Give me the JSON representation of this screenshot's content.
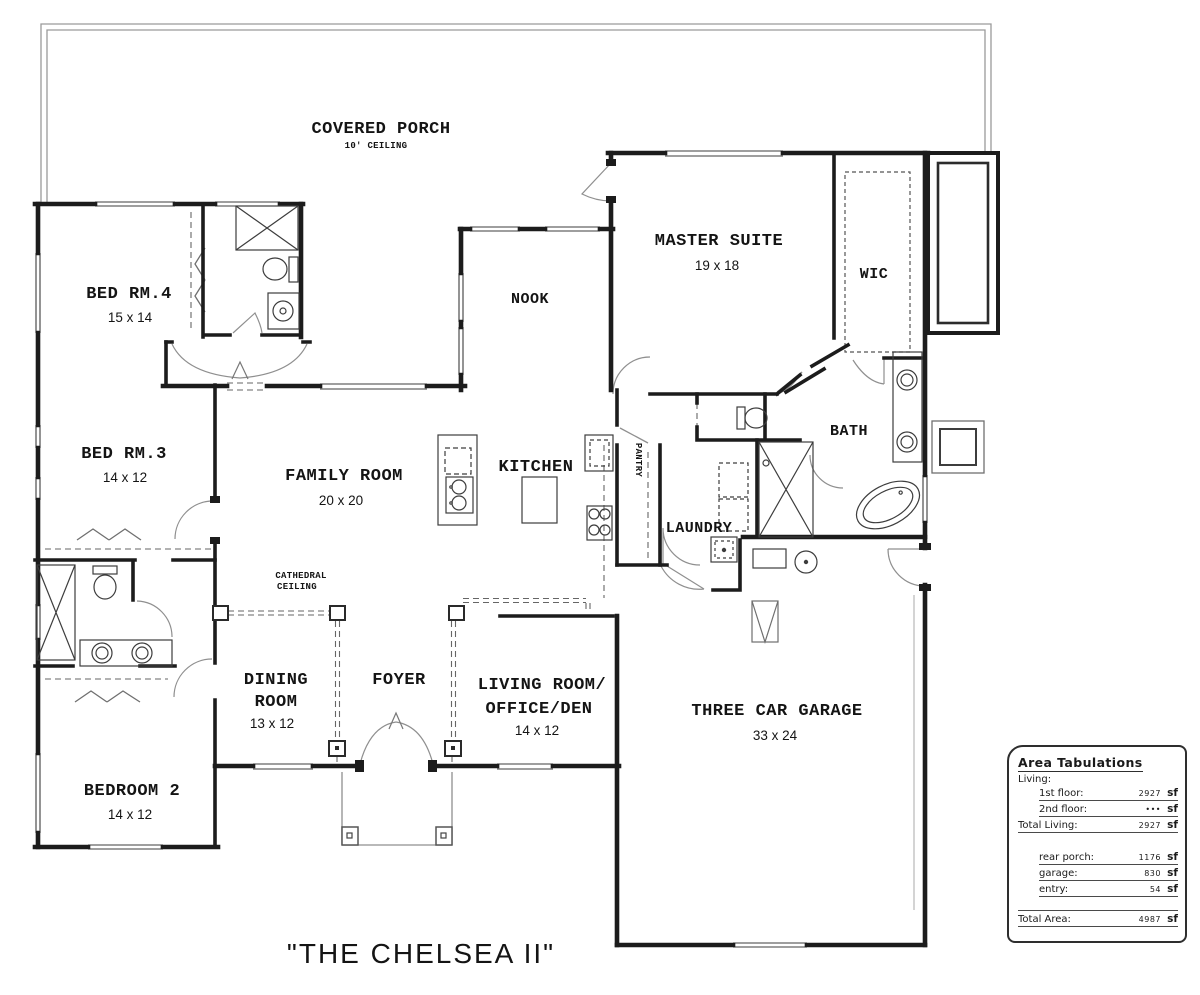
{
  "plan_title": "\"THE CHELSEA II\"",
  "rooms": {
    "covered_porch": {
      "name": "COVERED  PORCH",
      "note": "10' CEILING"
    },
    "bed_rm_4": {
      "name": "BED RM.4",
      "dims": "15 x 14"
    },
    "master_suite": {
      "name": "MASTER SUITE",
      "dims": "19 x 18"
    },
    "wic": {
      "name": "WIC"
    },
    "nook": {
      "name": "NOOK"
    },
    "bed_rm_3": {
      "name": "BED RM.3",
      "dims": "14 x 12"
    },
    "family_room": {
      "name": "FAMILY ROOM",
      "dims": "20 x 20"
    },
    "kitchen": {
      "name": "KITCHEN"
    },
    "pantry": {
      "name": "PANTRY"
    },
    "laundry": {
      "name": "LAUNDRY"
    },
    "bath": {
      "name": "BATH"
    },
    "cathedral_ceiling": {
      "line1": "CATHEDRAL",
      "line2": "CEILING"
    },
    "dining_room": {
      "line1": "DINING",
      "line2": "ROOM",
      "dims": "13 x 12"
    },
    "foyer": {
      "name": "FOYER"
    },
    "living_room": {
      "line1": "LIVING ROOM/",
      "line2": "OFFICE/DEN",
      "dims": "14 x 12"
    },
    "three_car_garage": {
      "name": "THREE CAR GARAGE",
      "dims": "33 x 24"
    },
    "bedroom_2": {
      "name": "BEDROOM 2",
      "dims": "14 x 12"
    }
  },
  "area_tabulations": {
    "title": "Area Tabulations",
    "living_header": "Living:",
    "rows": [
      {
        "label": "1st floor:",
        "value": "2927",
        "unit": "sf"
      },
      {
        "label": "2nd floor:",
        "value": "•••",
        "unit": "sf"
      },
      {
        "label": "Total Living:",
        "value": "2927",
        "unit": "sf"
      },
      {
        "label": "rear porch:",
        "value": "1176",
        "unit": "sf"
      },
      {
        "label": "garage:",
        "value": "830",
        "unit": "sf"
      },
      {
        "label": "entry:",
        "value": "54",
        "unit": "sf"
      },
      {
        "label": "Total Area:",
        "value": "4987",
        "unit": "sf"
      }
    ]
  }
}
